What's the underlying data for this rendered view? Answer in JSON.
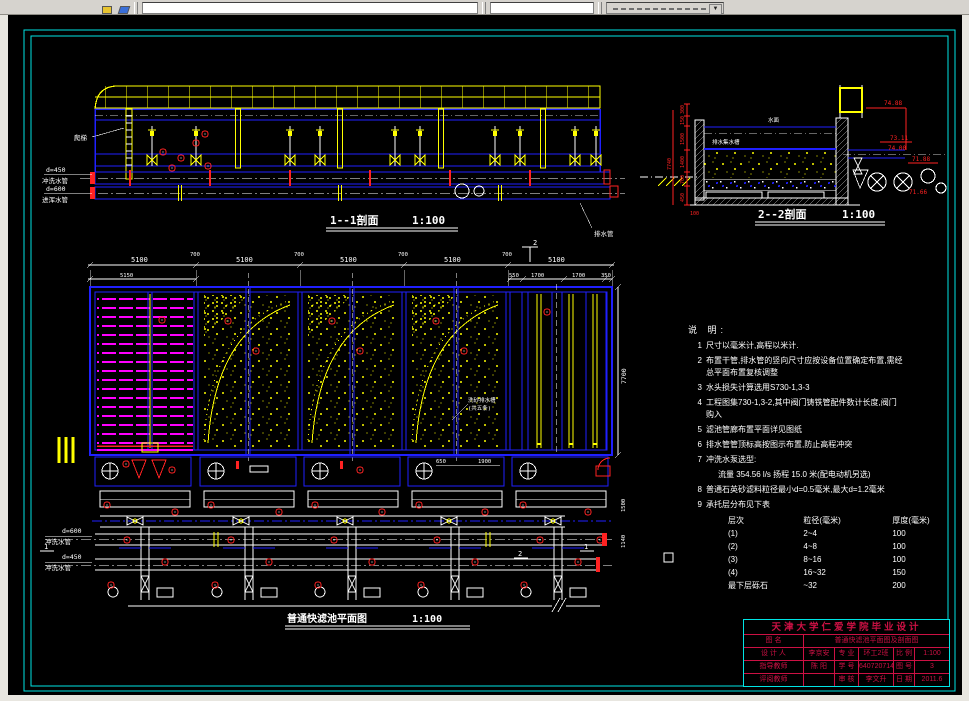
{
  "sections": {
    "s11": {
      "title": "1--1剖面",
      "scale": "1:100",
      "ladder_label": "爬梯",
      "pipes": [
        {
          "dia": "d=450",
          "name": "冲洗水管"
        },
        {
          "dia": "d=600",
          "name": "进浑水管"
        }
      ],
      "right_label": "排水管"
    },
    "s22": {
      "title": "2--2剖面",
      "scale": "1:100",
      "water_label": "水面",
      "channel_label": "排水集水槽",
      "elevations": [
        "74.88",
        "73.11",
        "74.00",
        "71.88",
        "71.66"
      ],
      "left_dims": [
        "300",
        "150",
        "1500",
        "1400",
        "700",
        "450"
      ],
      "overall_dim": "7740",
      "base_dim": "100"
    },
    "plan": {
      "title": "普通快滤池平面图",
      "scale": "1:100",
      "dims_top": [
        "5100",
        "5100",
        "5100",
        "5100",
        "5100"
      ],
      "gap_dim": "700",
      "dim_sub_left": "5150",
      "dims_sub_right": [
        "550",
        "1700",
        "1700",
        "350"
      ],
      "dim_right": "7700",
      "dims_gallery": [
        "1500",
        "1140"
      ],
      "dims_trough": [
        "650",
        "1900"
      ],
      "trough_label": "洗砂排水槽",
      "trough_label2": "(共五条)",
      "pipe_labels": [
        {
          "dia": "d=600",
          "name": "冲洗水管"
        },
        {
          "dia": "d=450",
          "name": "冲洗水管"
        }
      ],
      "markers": {
        "m1": "1",
        "m2": "2"
      }
    }
  },
  "notes": {
    "header": "说 明:",
    "items": [
      {
        "no": "1",
        "text": "尺寸以毫米计,高程以米计."
      },
      {
        "no": "2",
        "text": "布置干管,排水管的竖向尺寸应按设备位置确定布置,需经",
        "text2": "总平面布置复核调整"
      },
      {
        "no": "3",
        "text": "水头损失计算选用S730-1,3-3"
      },
      {
        "no": "4",
        "text": "工程图集730-1,3-2,其中阀门铸铁管配件数计长度,阀门",
        "text2": "购入"
      },
      {
        "no": "5",
        "text": "滤池管廊布置平面详见图纸"
      },
      {
        "no": "6",
        "text": "排水管管顶标高按图示布置,防止高程冲突"
      },
      {
        "no": "7",
        "text": "冲洗水泵选型:"
      },
      {
        "no": "",
        "text": "流量 354.56 l/s 扬程 15.0 米(配电动机另选)"
      },
      {
        "no": "8",
        "text": "普通石英砂滤料粒径最小d=0.5毫米,最大d=1.2毫米"
      },
      {
        "no": "9",
        "text": "承托层分布见下表"
      }
    ],
    "table": {
      "headers": [
        "层次",
        "粒径(毫米)",
        "厚度(毫米)"
      ],
      "rows": [
        [
          "(1)",
          "2~4",
          "100"
        ],
        [
          "(2)",
          "4~8",
          "100"
        ],
        [
          "(3)",
          "8~16",
          "100"
        ],
        [
          "(4)",
          "16~32",
          "150"
        ],
        [
          "最下层砾石",
          "~32",
          "200"
        ]
      ]
    }
  },
  "titleblock": {
    "school": "天津大学仁爱学院毕业设计",
    "name_label": "图  名",
    "name": "普通快滤池平面图及剖面图",
    "rows": [
      {
        "l1": "设 计 人",
        "v1": "李京安",
        "l2": "专 业",
        "v2": "环工2班",
        "l3": "比 例",
        "v3": "1:100"
      },
      {
        "l1": "指导教师",
        "v1": "陈 阳",
        "l2": "学 号",
        "v2": "6407207140",
        "l3": "图 号",
        "v3": "3"
      },
      {
        "l1": "评阅教师",
        "v1": "",
        "l2": "审 核",
        "v2": "李文升",
        "l3": "日 期",
        "v3": "2011.6"
      }
    ]
  },
  "colors": {
    "frame": "#00e5e5",
    "blue": "#2020ff",
    "yellow": "#ffff00",
    "magenta": "#ff00ff",
    "red": "#ff2222",
    "titleblock_red": "#cc1144",
    "text": "#ffffff"
  }
}
